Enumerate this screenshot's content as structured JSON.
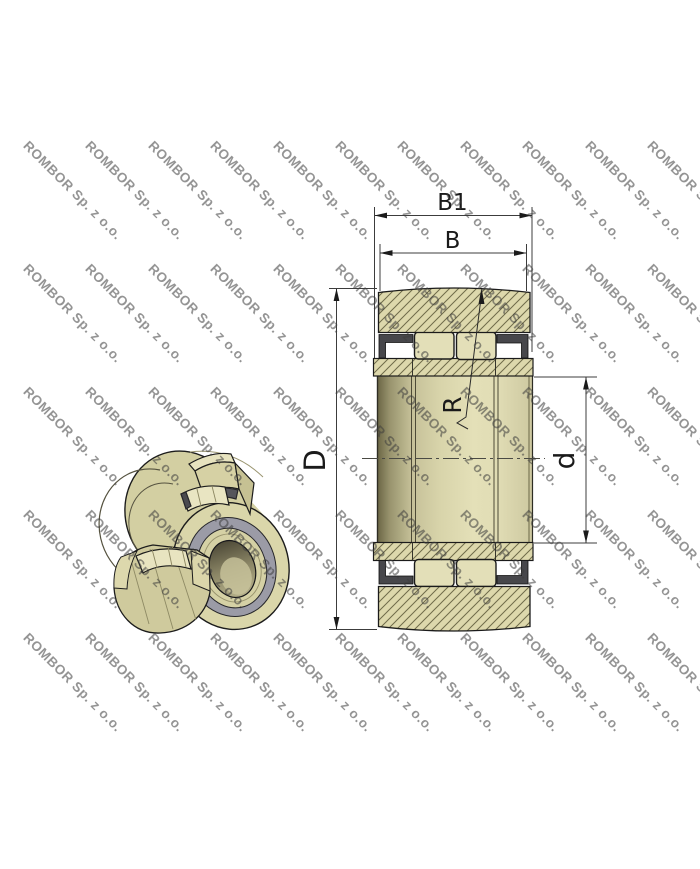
{
  "drawing": {
    "title": "Yoke type track roller bearing - cross section and 3D cutaway view"
  },
  "watermark": {
    "text": "ROMBOR Sp. z o.o.",
    "color": "#8b8b8b"
  },
  "labels": {
    "total_width": "B1",
    "outer_ring_width": "B",
    "outer_diameter": "D",
    "bore_diameter": "d",
    "crown_radius": "R"
  },
  "colors": {
    "section_fill": "#ddd8ac",
    "hatch_line": "#6f6b4a",
    "roller_fill": "#e3dfb8",
    "side_plate": "#47474b",
    "outline": "#1b1b1b",
    "iso_body": "#d3cfa2",
    "iso_face": "#dad6aa",
    "iso_gray_ring": "#9b9ba6",
    "dim_line": "#2a2a2a"
  }
}
